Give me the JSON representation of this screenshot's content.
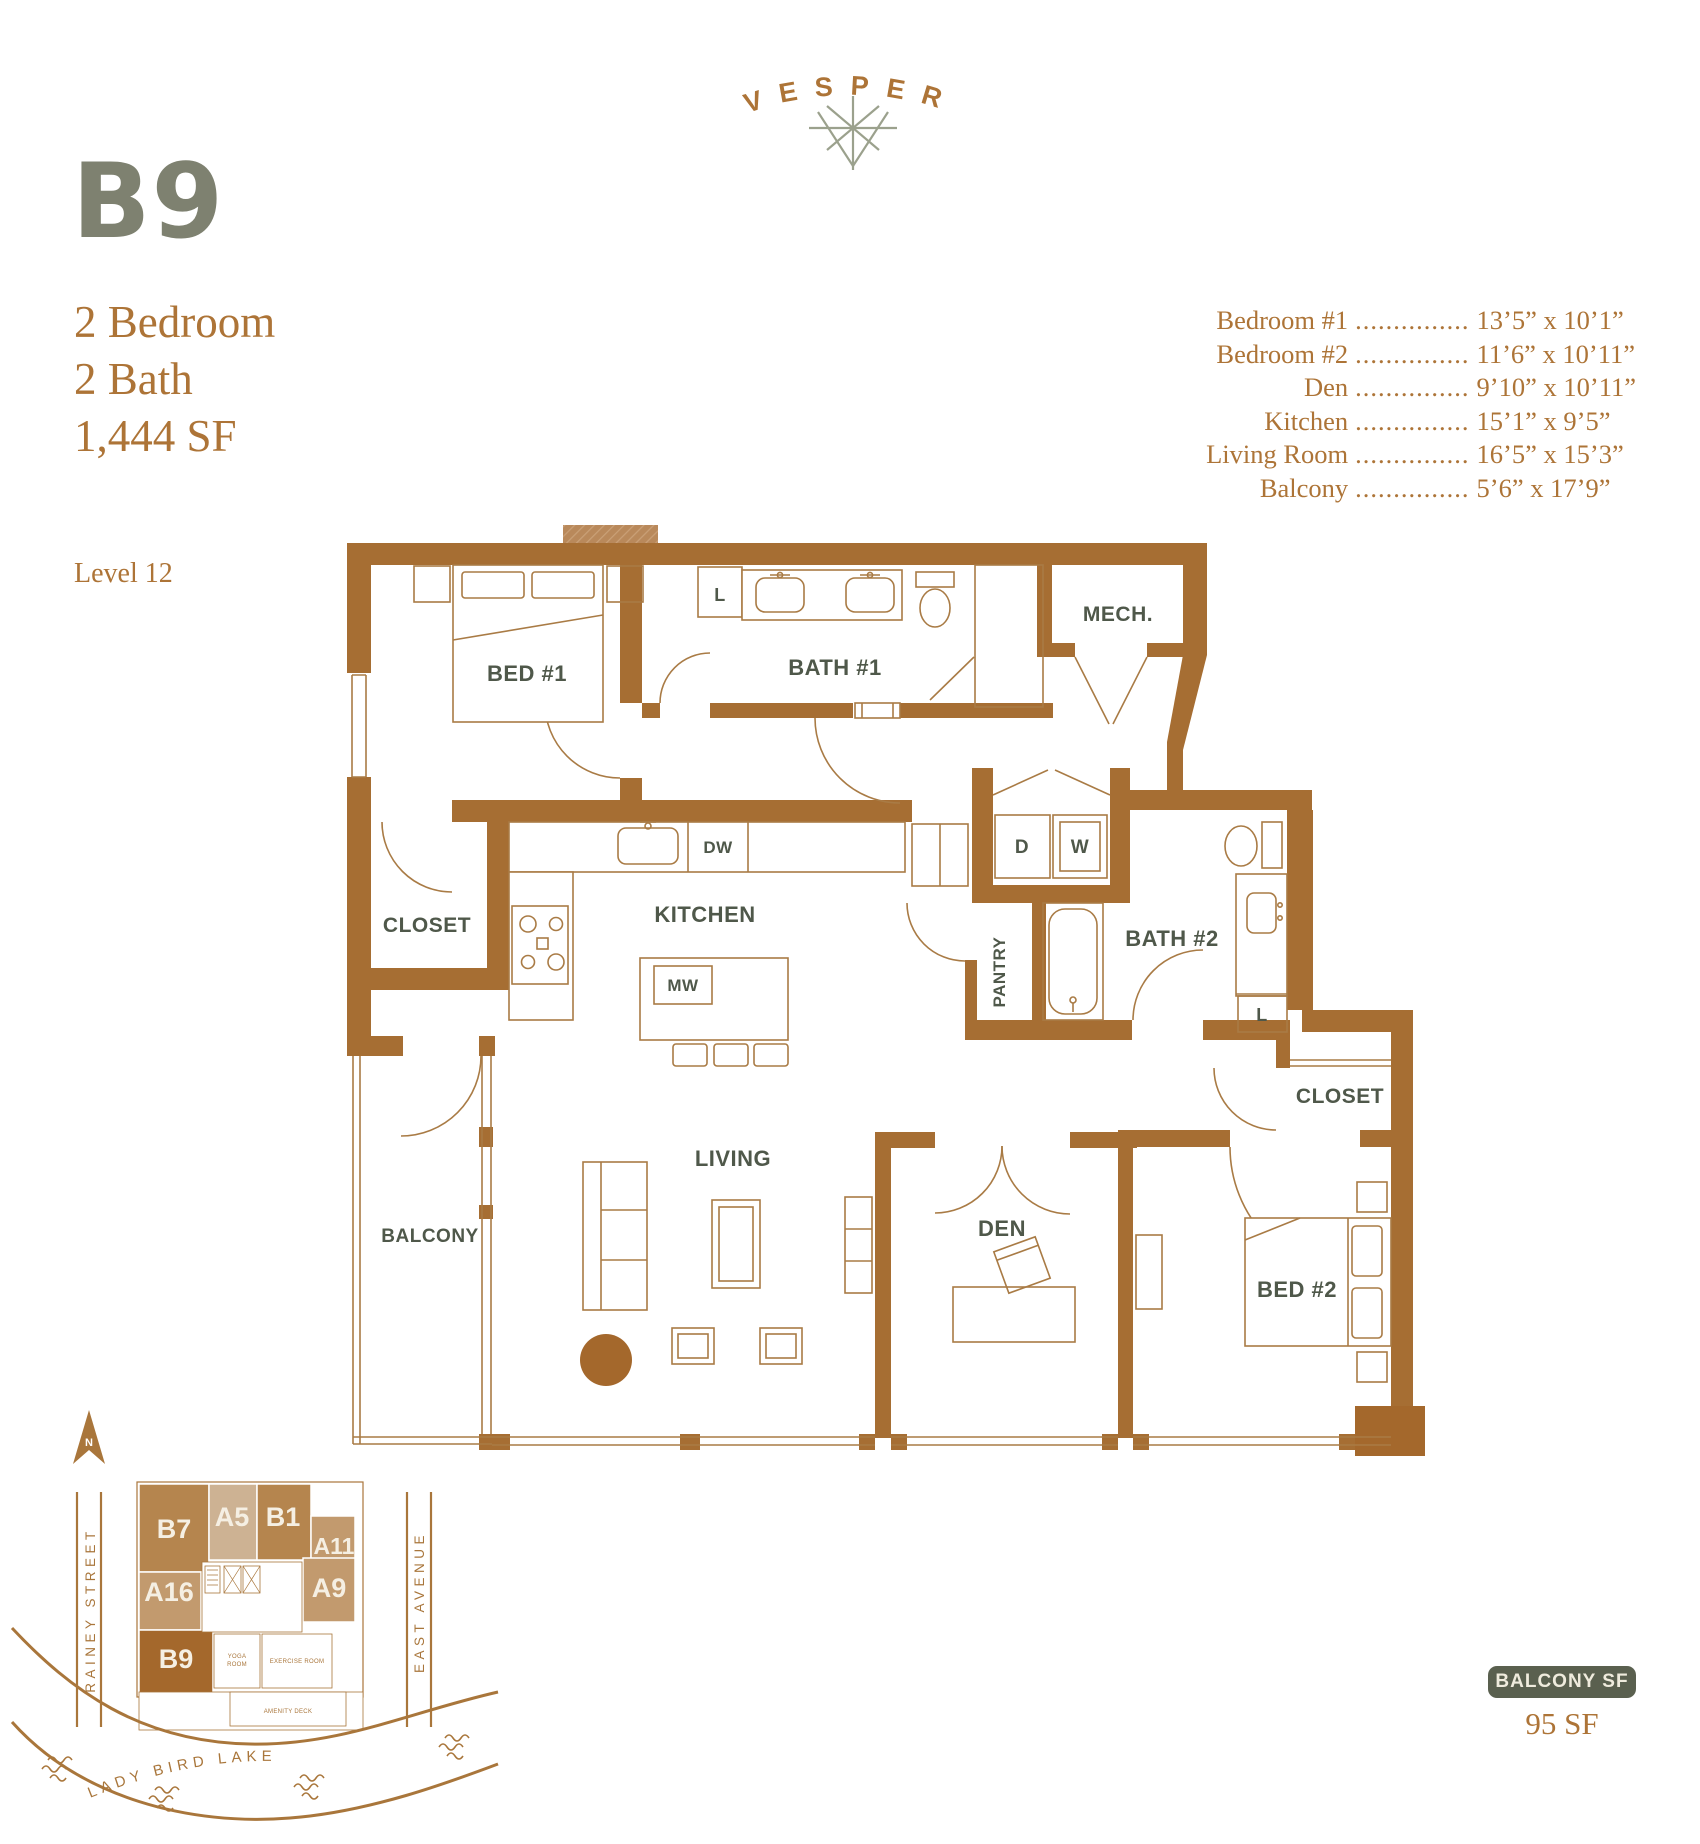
{
  "brand": {
    "logo_text": "VESPER"
  },
  "header": {
    "unit_code": "B9",
    "specs": [
      "2 Bedroom",
      "2 Bath",
      "1,444 SF"
    ],
    "level": "Level 12"
  },
  "dimensions": {
    "leader": "...............",
    "rows": [
      {
        "label": "Bedroom #1",
        "value": "13’5” x 10’1”"
      },
      {
        "label": "Bedroom #2",
        "value": "11’6” x 10’11”"
      },
      {
        "label": "Den",
        "value": "9’10” x 10’11”"
      },
      {
        "label": "Kitchen",
        "value": "15’1” x 9’5”"
      },
      {
        "label": "Living Room",
        "value": "16’5” x 15’3”"
      },
      {
        "label": "Balcony",
        "value": "5’6” x 17’9”"
      }
    ]
  },
  "floorplan": {
    "labels": {
      "bed1": "BED #1",
      "bath1": "BATH #1",
      "linen1": "L",
      "mech": "MECH.",
      "closet1": "CLOSET",
      "kitchen": "KITCHEN",
      "dw": "DW",
      "mw": "MW",
      "dryer": "D",
      "washer": "W",
      "pantry": "PANTRY",
      "bath2": "BATH #2",
      "linen2": "L",
      "closet2": "CLOSET",
      "den": "DEN",
      "living": "LIVING",
      "balcony": "BALCONY",
      "bed2": "BED #2"
    }
  },
  "siteplan": {
    "north_label": "N",
    "streets": {
      "left": "RAINEY STREET",
      "right": "EAST AVENUE"
    },
    "lake_label": "LADY BIRD LAKE",
    "highlighted_unit": "B9",
    "units": {
      "b7": "B7",
      "a5": "A5",
      "b1": "B1",
      "a11": "A11",
      "a16": "A16",
      "a9": "A9",
      "b9": "B9"
    },
    "amenities": {
      "yoga1": "YOGA",
      "yoga2": "ROOM",
      "exercise": "EXERCISE ROOM",
      "deck": "AMENITY DECK"
    }
  },
  "balcony_callout": {
    "label": "BALCONY SF",
    "value": "95 SF"
  },
  "colors": {
    "copper_text": "#ad7437",
    "wall_brown": "#a66e33",
    "furniture_line": "#a97b45",
    "sage_title": "#7e8170",
    "room_label": "#4f584a",
    "badge_bg": "#5a604f",
    "badge_text": "#efebdd",
    "star_sage": "#9ba18d",
    "site_dark": "#a4682c",
    "site_mid": "#b5854e",
    "site_light": "#cdb293",
    "site_tan": "#c29a6e"
  }
}
